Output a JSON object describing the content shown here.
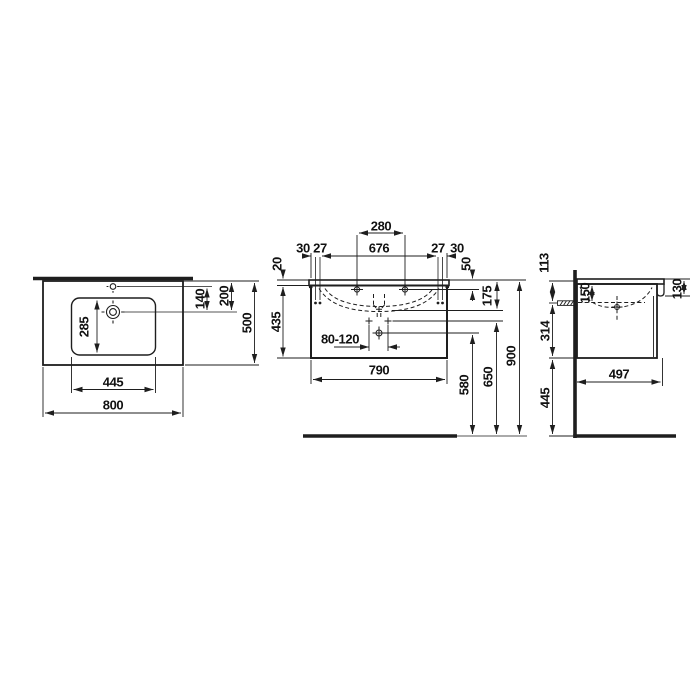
{
  "drawing": {
    "type": "technical-dimension-drawing",
    "subject": "washbasin with vanity unit – top, front and side views",
    "background": "#ffffff",
    "line_color": "#1e1e1e",
    "text_color": "#111111",
    "units": "mm",
    "views": {
      "top_view": {
        "overall_width": "800",
        "overall_depth": "500",
        "bowl_width": "445",
        "bowl_depth": "285",
        "tap_hole_to_drain": "140",
        "back_edge_to_drain": "200"
      },
      "front_view": {
        "tap_hole_spacing": "280",
        "left_offset_outer": "30",
        "left_offset_inner": "27",
        "fixing_span": "676",
        "right_offset_inner": "27",
        "right_offset_outer": "30",
        "worktop_thickness": "20",
        "top_to_fixing": "50",
        "top_to_bowl_bottom": "175",
        "cabinet_height": "435",
        "drain_range": "80-120",
        "cabinet_width": "790",
        "floor_to_drain": "580",
        "floor_to_trap": "650",
        "floor_to_top": "900"
      },
      "side_view": {
        "top_to_fixing": "113",
        "fixing_inset": "150",
        "front_edge_height": "130",
        "fixing_to_cabinet_bottom": "314",
        "cabinet_bottom_to_floor": "445",
        "total_depth": "497"
      }
    }
  }
}
